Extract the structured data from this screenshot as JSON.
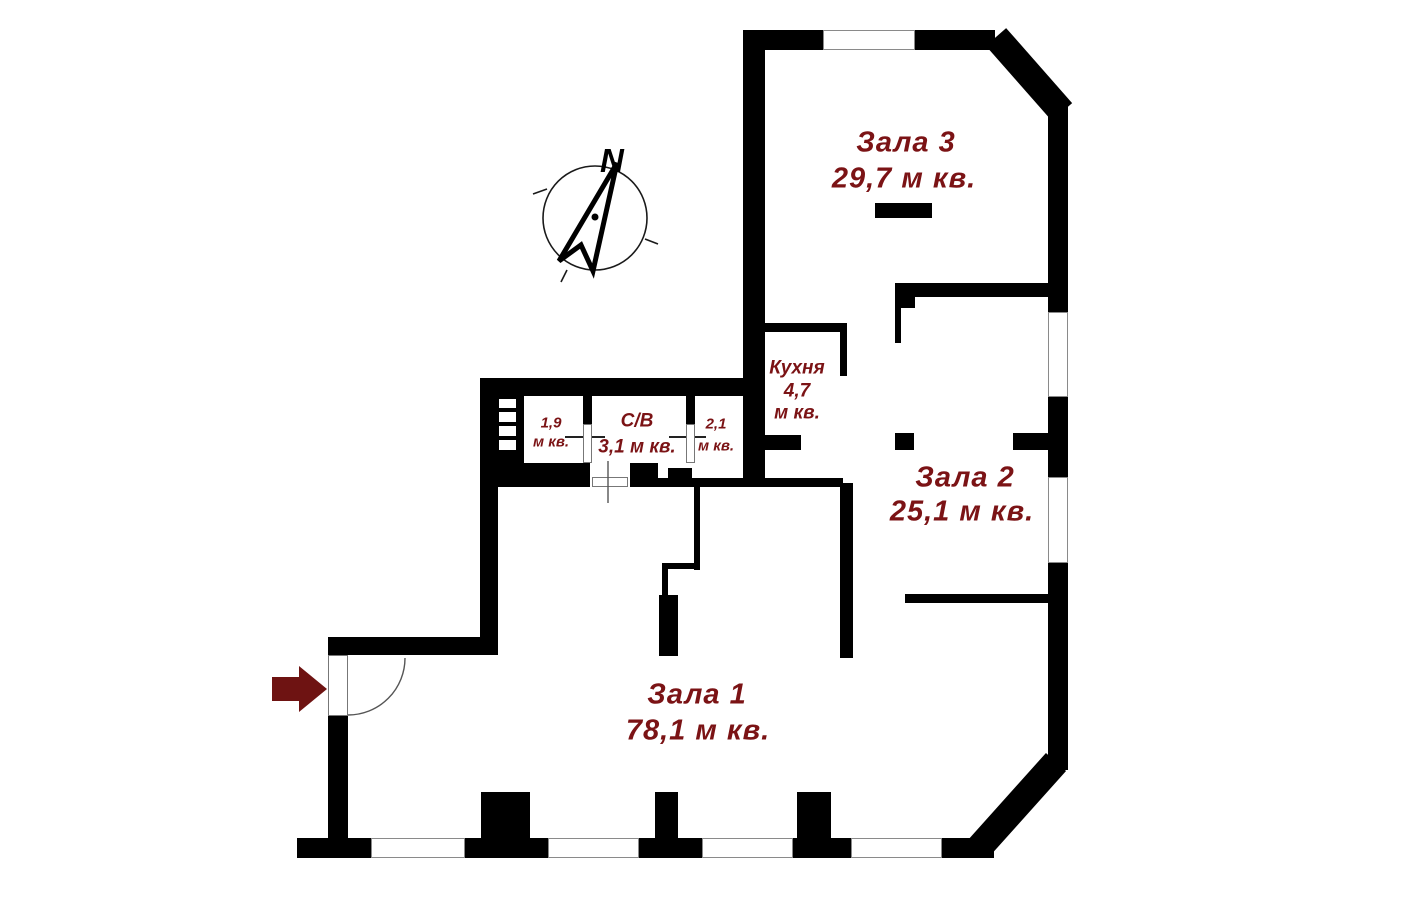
{
  "colors": {
    "wall": "#000000",
    "label": "#7b1315",
    "entrance_arrow": "#6e1312",
    "window_border": "#8a8a8a",
    "compass": "#1a1a1a"
  },
  "compass": {
    "north_label": "N"
  },
  "rooms": {
    "zala3": {
      "name": "Зала 3",
      "area": "29,7 м кв."
    },
    "zala2": {
      "name": "Зала 2",
      "area": "25,1 м кв."
    },
    "zala1": {
      "name": "Зала 1",
      "area": "78,1 м кв."
    },
    "kitchen": {
      "name": "Кухня",
      "area_value": "4,7",
      "area_unit": "м кв."
    },
    "bathroom": {
      "name": "С/В",
      "area": "3,1 м кв."
    },
    "storage_left": {
      "area_value": "1,9",
      "area_unit": "м кв."
    },
    "storage_right": {
      "area_value": "2,1",
      "area_unit": "м кв."
    }
  }
}
